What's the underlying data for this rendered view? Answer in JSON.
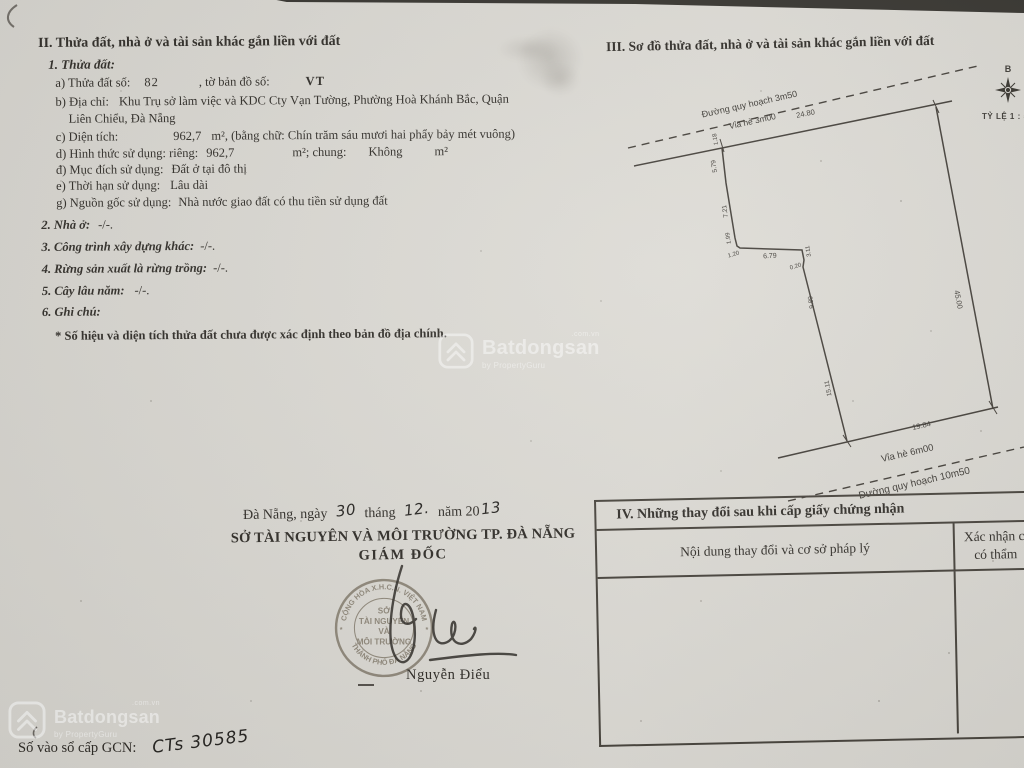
{
  "section2": {
    "title": "II. Thửa đất, nhà ở và tài sản khác gắn liền với đất",
    "sub1_heading": "1. Thửa đất:",
    "a_label": "a) Thửa đất số:",
    "a_value": "82",
    "a_label2": ", tờ bản đồ số:",
    "a_value2": "VT",
    "b_label": "b) Địa chỉ:",
    "b_line1": "Khu Trụ sở làm việc và KDC Cty Vạn Tường, Phường Hoà Khánh Bắc, Quận",
    "b_line2": "Liên Chiểu, Đà Nẵng",
    "c_label": "c) Diện tích:",
    "c_value": "962,7",
    "c_rest": "m², (bằng chữ: Chín trăm sáu mươi hai phẩy bảy mét vuông)",
    "d_label": "d) Hình thức sử dụng: riêng:",
    "d_value": "962,7",
    "d_mid": "m²; chung:",
    "d_value2": "Không",
    "d_unit": "m²",
    "dd_label": "đ) Mục đích sử dụng:",
    "dd_value": "Đất ở tại đô thị",
    "e_label": "e) Thời hạn sử dụng:",
    "e_value": "Lâu dài",
    "g_label": "g) Nguồn gốc sử dụng:",
    "g_value": "Nhà nước giao đất có thu tiền sử dụng đất",
    "sub2": "2. Nhà ở:",
    "sub2_value": "-/-.",
    "sub3": "3. Công trình xây dựng khác:",
    "sub3_value": "-/-.",
    "sub4": "4. Rừng sản xuất là rừng trồng:",
    "sub4_value": "-/-.",
    "sub5": "5. Cây lâu năm:",
    "sub5_value": "-/-.",
    "sub6": "6. Ghi chú:",
    "note": "* Số hiệu và diện tích thửa đất chưa được xác định theo bản đồ địa chính."
  },
  "section3": {
    "title": "III. Sơ đồ thửa đất, nhà ở và tài sản khác gắn liền với đất",
    "compass": "B",
    "scale": "TỶ LỆ 1 : 500",
    "road_top": "Đường quy hoạch 3m50",
    "sidewalk_top": "Vỉa hè 3m00",
    "sidewalk_bottom": "Vỉa hè 6m00",
    "road_bottom": "Đường quy hoạch 10m50",
    "dims": {
      "top": "24.80",
      "right": "45.00",
      "bottom": "19.84",
      "l1": "1.18",
      "l2": "5.79",
      "l3": "7.21",
      "l4": "1.99",
      "l5": "1.20",
      "l6": "6.79",
      "l7": "3.11",
      "l8": "0.20",
      "l9": "9.89",
      "l10": "15.11"
    }
  },
  "section4": {
    "title": "IV. Những thay đổi sau khi cấp giấy chứng nhận",
    "col1": "Nội dung thay đổi và cơ sở pháp lý",
    "col2_line1": "Xác nhận c",
    "col2_line2": "có thẩm"
  },
  "signature": {
    "date_prefix": "Đà Nẵng, ngày",
    "day": "30",
    "month_label": "tháng",
    "month": "12.",
    "year_label": "năm 20",
    "year": "13",
    "org": "SỞ TÀI NGUYÊN VÀ MÔI TRƯỜNG TP. ĐÀ NẴNG",
    "role": "GIÁM ĐỐC",
    "signer": "Nguyễn Điểu",
    "stamp_top": "CỘNG HÒA X.H.C.N. VIỆT NAM",
    "stamp_center1": "SỞ",
    "stamp_center2": "TÀI NGUYÊN",
    "stamp_center3": "VÀ",
    "stamp_center4": "MÔI TRƯỜNG",
    "stamp_bottom": "THÀNH PHỐ ĐÀ NẴNG",
    "stamp_star": "*"
  },
  "footer": {
    "gcn_label": "Số vào sổ cấp GCN:",
    "gcn_value": "CTs 30585"
  },
  "watermark": {
    "brand": "Batdongsan",
    "domain": ".com.vn",
    "byline": "by PropertyGuru"
  }
}
